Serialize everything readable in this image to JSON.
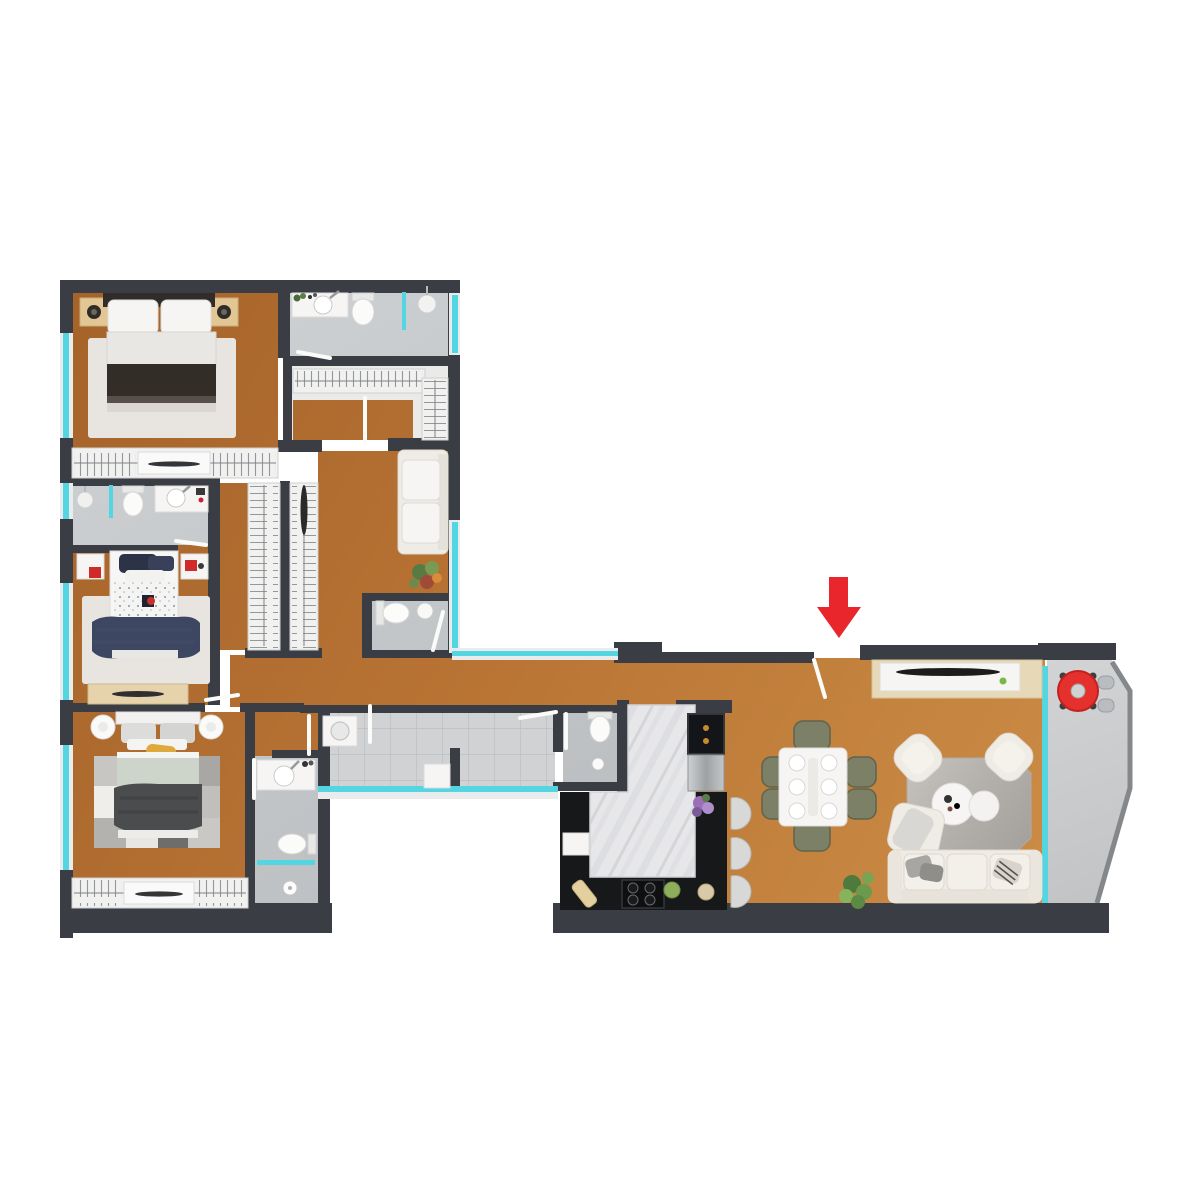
{
  "title": "apartment-floor-plan-top-view",
  "colors": {
    "background": "#ffffff",
    "wall": "#3a3e44",
    "window_glass": "#54d5e2",
    "wood_floor_dark": "#a5632a",
    "wood_floor_light": "#cd8f48",
    "bath_floor": "#c6c9cb",
    "laundry_tile": "#d0d2d4",
    "balcony_floor": "#c9cacc",
    "rug_light": "#e8e5e0",
    "rug_living": "#b9b6b1",
    "furniture_white": "#f6f5f3",
    "furniture_cream": "#efece6",
    "counter_black": "#17181a",
    "marble_island": "#e7e7e9",
    "steel_fridge": "#b9bcbe",
    "nightstand_beige": "#e2c795",
    "bench_beige": "#e6d3ac",
    "olive_chair": "#7c8066",
    "navy_blanket": "#3d4761",
    "dark_blanket": "#332d27",
    "sage_blanket": "#cdd4c9",
    "yellow_pillow": "#e0a93e",
    "plant_green": "#6b9a4c",
    "accent_red": "#e8262b"
  },
  "rooms": [
    {
      "id": "master-bedroom"
    },
    {
      "id": "ensuite-bathroom"
    },
    {
      "id": "walk-in-closet"
    },
    {
      "id": "bedroom-2"
    },
    {
      "id": "bathroom-2"
    },
    {
      "id": "wardrobe-corridor"
    },
    {
      "id": "bedroom-3"
    },
    {
      "id": "bathroom-3"
    },
    {
      "id": "guest-wc"
    },
    {
      "id": "hallway"
    },
    {
      "id": "laundry-area"
    },
    {
      "id": "kitchen-bathroom"
    },
    {
      "id": "kitchen"
    },
    {
      "id": "dining-area"
    },
    {
      "id": "living-room"
    },
    {
      "id": "balcony"
    },
    {
      "id": "entrance"
    }
  ],
  "entrance_marker": {
    "icon": "arrow-down-icon",
    "color": "#e8262b"
  }
}
